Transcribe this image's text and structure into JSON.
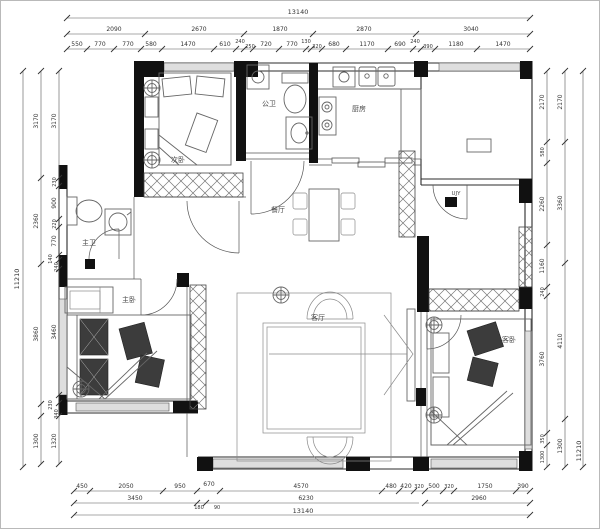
{
  "rooms": {
    "secondary_bedroom": "次卧",
    "guest_bathroom": "公卫",
    "kitchen": "厨房",
    "master_bathroom": "主卫",
    "dining_room": "餐厅",
    "living_room": "客厅",
    "master_bedroom": "主卧",
    "guest_bedroom": "客卧",
    "entry_label": "UJY"
  },
  "dimensions": {
    "top": {
      "total": "13140",
      "row2": [
        "2090",
        "2670",
        "1870",
        "2870",
        "3040"
      ],
      "row3": [
        "550",
        "770",
        "770",
        "580",
        "1470",
        "610",
        "240",
        "250",
        "720",
        "770",
        "130",
        "320",
        "680",
        "1170",
        "690",
        "240",
        "390",
        "1180",
        "1470"
      ]
    },
    "bottom": {
      "total": "13140",
      "row2": [
        "3450",
        "180",
        "90",
        "6230",
        "2960"
      ],
      "row1": [
        "450",
        "2050",
        "950",
        "670",
        "4570",
        "480",
        "420",
        "320",
        "500",
        "320",
        "1750",
        "390"
      ]
    },
    "left": {
      "outer": "11210",
      "middle": [
        "3170",
        "2360",
        "3860",
        "1300"
      ],
      "inner": [
        "3170",
        "230",
        "900",
        "220",
        "770",
        "140",
        "240",
        "3460",
        "230",
        "340",
        "1320"
      ]
    },
    "right": {
      "outer": "11210",
      "middle": [
        "2170",
        "3360",
        "4110",
        "1300"
      ],
      "inner": [
        "2170",
        "580",
        "2260",
        "1160",
        "240",
        "3760",
        "350",
        "1300"
      ]
    }
  },
  "colors": {
    "wall": "#111111",
    "line": "#555555",
    "dim": "#3a3a3a",
    "window_fill": "#dedede"
  }
}
